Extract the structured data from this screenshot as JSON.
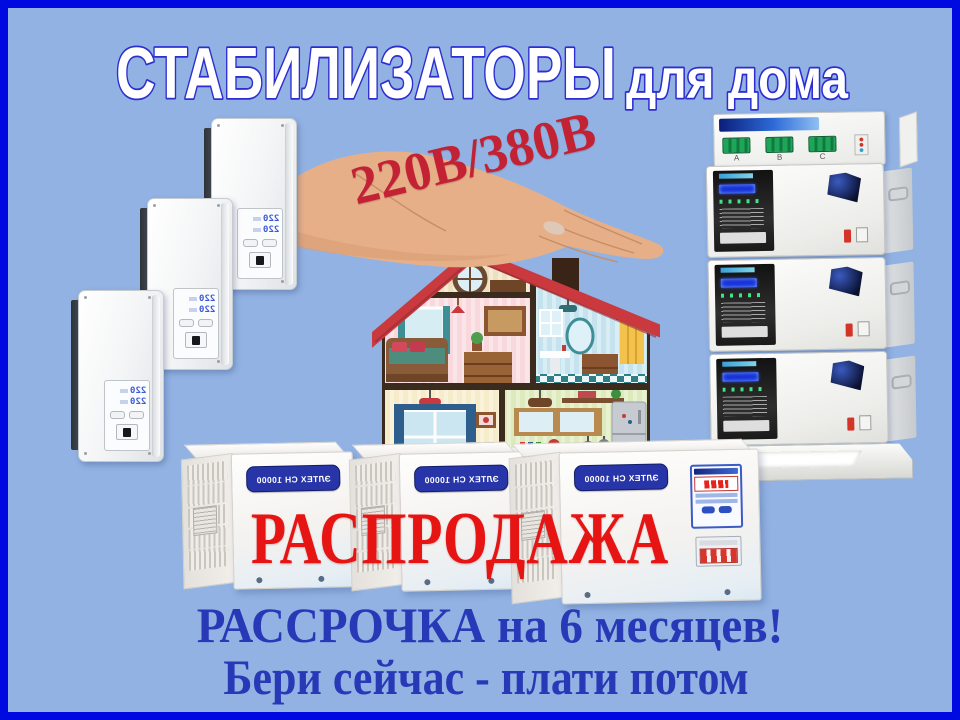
{
  "banner": {
    "title": {
      "main": "СТАБИЛИЗАТОРЫ",
      "suffix": "для дома"
    },
    "voltage_label": "220В/380В",
    "sale_label": "РАСПРОДАЖА",
    "installment_line1": "РАССРОЧКА на 6 месяцев!",
    "installment_line2": "Бери сейчас - плати потом"
  },
  "products": {
    "floor_unit_badge": "ЭЛТЕХ СН 10000",
    "wall_display": {
      "row1": "220",
      "row2": "220"
    },
    "tower_phases": [
      "A",
      "B",
      "C"
    ]
  },
  "colors": {
    "background": "#91B2E3",
    "frame": "#0009E0",
    "title_fill": "#FFFFFF",
    "title_outline": "#2D2DD0",
    "voltage_red": "#C32134",
    "sale_red": "#E71414",
    "installment_blue": "#2839B8",
    "badge_navy": "#2735A8"
  }
}
